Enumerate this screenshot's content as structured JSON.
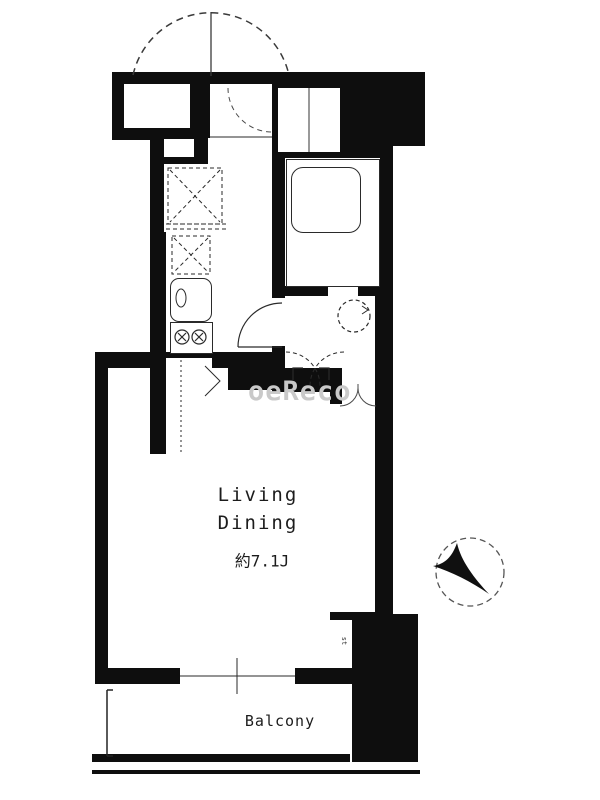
{
  "rooms": {
    "living_dining": {
      "name": "Living",
      "name2": "Dining",
      "area": "約7.1J"
    },
    "kitchen": {
      "name": "Kitchen",
      "area": "約2.3J"
    },
    "balcony": {
      "name": "Balcony"
    },
    "entrance": {
      "name": "Entrance"
    },
    "shoes_closet": {
      "line1": "Shoes",
      "line2": "Closet"
    },
    "bath_room": {
      "line1": "Bath",
      "line2": "Room"
    },
    "powder_room": {
      "line1": "Powder",
      "line2": "Room"
    },
    "hall": {
      "name": "Hall"
    },
    "closet": {
      "name": "Closet"
    },
    "meter_box": {
      "name": "MB"
    },
    "pipe_space": {
      "name": "PS"
    },
    "washer_dryer": {
      "name": "W/D"
    },
    "refrigerator": {
      "name": "R"
    },
    "storage_small": {
      "name": "st"
    }
  },
  "watermark": "oeReco",
  "colors": {
    "wall": "#0e0e0e",
    "line": "#2a2a2a",
    "watermark": "#c9c9c9"
  }
}
